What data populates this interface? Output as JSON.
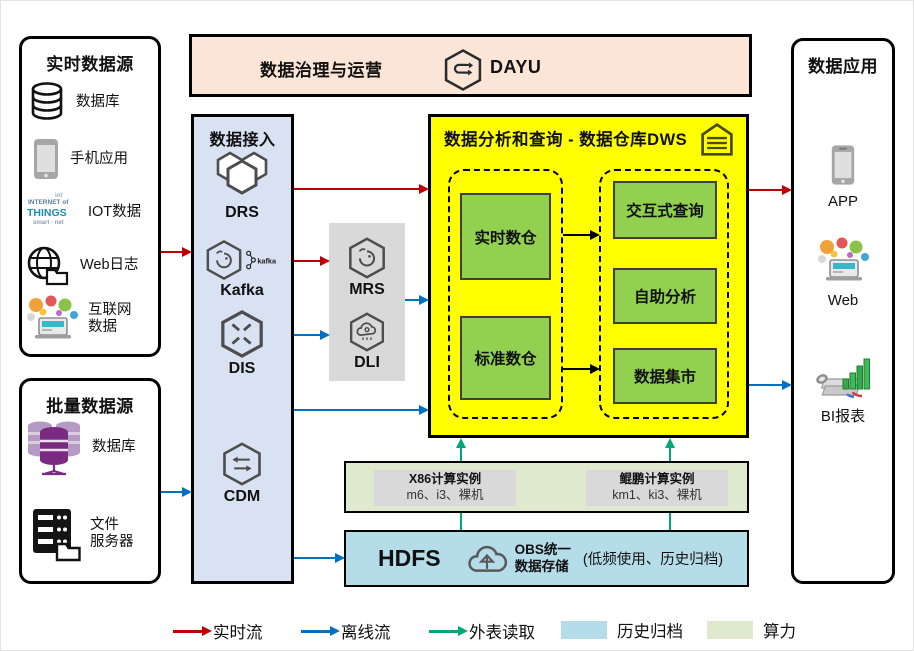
{
  "realtime_sources": {
    "title": "实时数据源",
    "items": [
      {
        "label": "数据库"
      },
      {
        "label": "手机应用"
      },
      {
        "label": "IOT数据"
      },
      {
        "label": "Web日志"
      },
      {
        "label": "互联网\n数据"
      }
    ]
  },
  "batch_sources": {
    "title": "批量数据源",
    "items": [
      {
        "label": "数据库"
      },
      {
        "label": "文件\n服务器"
      }
    ]
  },
  "governance": {
    "title": "数据治理与运营",
    "product": "DAYU"
  },
  "access": {
    "title": "数据接入",
    "services": [
      {
        "name": "DRS"
      },
      {
        "name": "Kafka",
        "logo_text": "kafka"
      },
      {
        "name": "DIS"
      },
      {
        "name": "CDM"
      }
    ]
  },
  "processing": {
    "services": [
      {
        "name": "MRS"
      },
      {
        "name": "DLI"
      }
    ]
  },
  "dws": {
    "title": "数据分析和查询 - 数据仓库DWS",
    "left_group": [
      {
        "label": "实时数仓"
      },
      {
        "label": "标准数仓"
      }
    ],
    "right_group": [
      {
        "label": "交互式查询"
      },
      {
        "label": "自助分析"
      },
      {
        "label": "数据集市"
      }
    ]
  },
  "compute": {
    "instances": [
      {
        "title": "X86计算实例",
        "detail": "m6、i3、裸机"
      },
      {
        "title": "鲲鹏计算实例",
        "detail": "km1、ki3、裸机"
      }
    ]
  },
  "storage": {
    "name": "HDFS",
    "obs_label": "OBS统一\n数据存储",
    "note": "(低频使用、历史归档)"
  },
  "apps": {
    "title": "数据应用",
    "items": [
      {
        "label": "APP"
      },
      {
        "label": "Web"
      },
      {
        "label": "BI报表"
      }
    ]
  },
  "legend": {
    "items": [
      {
        "label": "实时流",
        "kind": "arrow",
        "color": "#c00000"
      },
      {
        "label": "离线流",
        "kind": "arrow",
        "color": "#0070c0"
      },
      {
        "label": "外表读取",
        "kind": "arrow",
        "color": "#00a878"
      },
      {
        "label": "历史归档",
        "kind": "swatch",
        "color": "#b5dde9"
      },
      {
        "label": "算力",
        "kind": "swatch",
        "color": "#dfe9cd"
      }
    ]
  },
  "iot_icon": {
    "line1": "INTERNET of",
    "line2": "THINGS",
    "line3": "smart · net",
    "line4": "iot"
  },
  "colors": {
    "realtime_flow": "#c00000",
    "offline_flow": "#0070c0",
    "external_read": "#00a878",
    "history_archive": "#b5dde9",
    "compute_power": "#dfe9cd",
    "dws_background": "#ffff00",
    "warehouse_green": "#92d050",
    "access_background": "#d9e2f3",
    "governance_background": "#fbe5d6",
    "processing_background": "#d9d9d9"
  }
}
